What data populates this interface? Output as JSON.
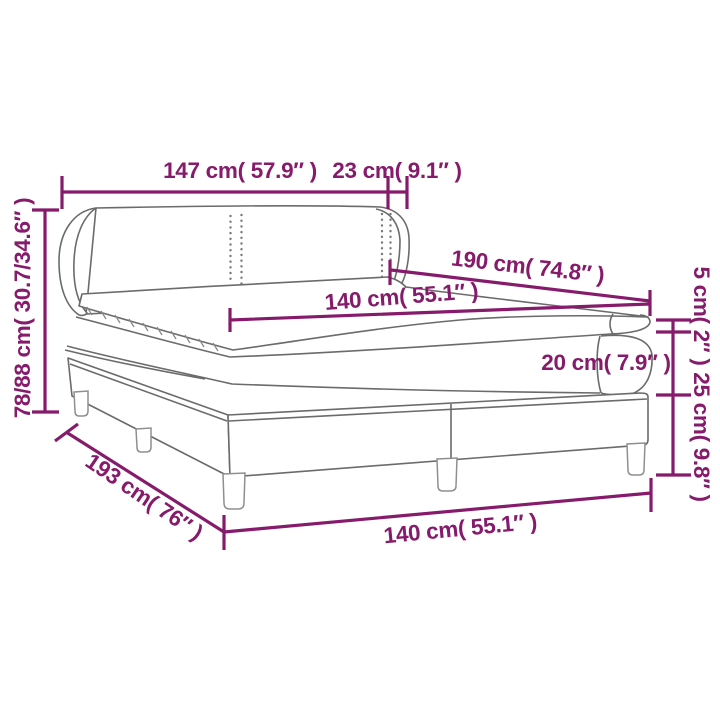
{
  "diagram": {
    "kind": "product-dimension-diagram",
    "subject": "box-spring-bed-with-headboard-topper",
    "background_color": "#ffffff",
    "accent_color": "#861b6b",
    "artwork_line_color": "#6b6b6b"
  },
  "labels": {
    "headboard_width": "147 cm( 57.9″ )",
    "wing_depth": "23 cm( 9.1″ )",
    "headboard_height": "78/88 cm( 30.7/34.6″ )",
    "bed_length_top": "190 cm( 74.8″ )",
    "mattress_width": "140 cm( 55.1″ )",
    "topper_height": "5 cm( 2″ )",
    "mattress_height": "20 cm( 7.9″ )",
    "base_height": "25 cm( 9.8″ )",
    "bed_length_bottom": "193 cm( 76″ )",
    "base_width": "140 cm( 55.1″ )"
  }
}
